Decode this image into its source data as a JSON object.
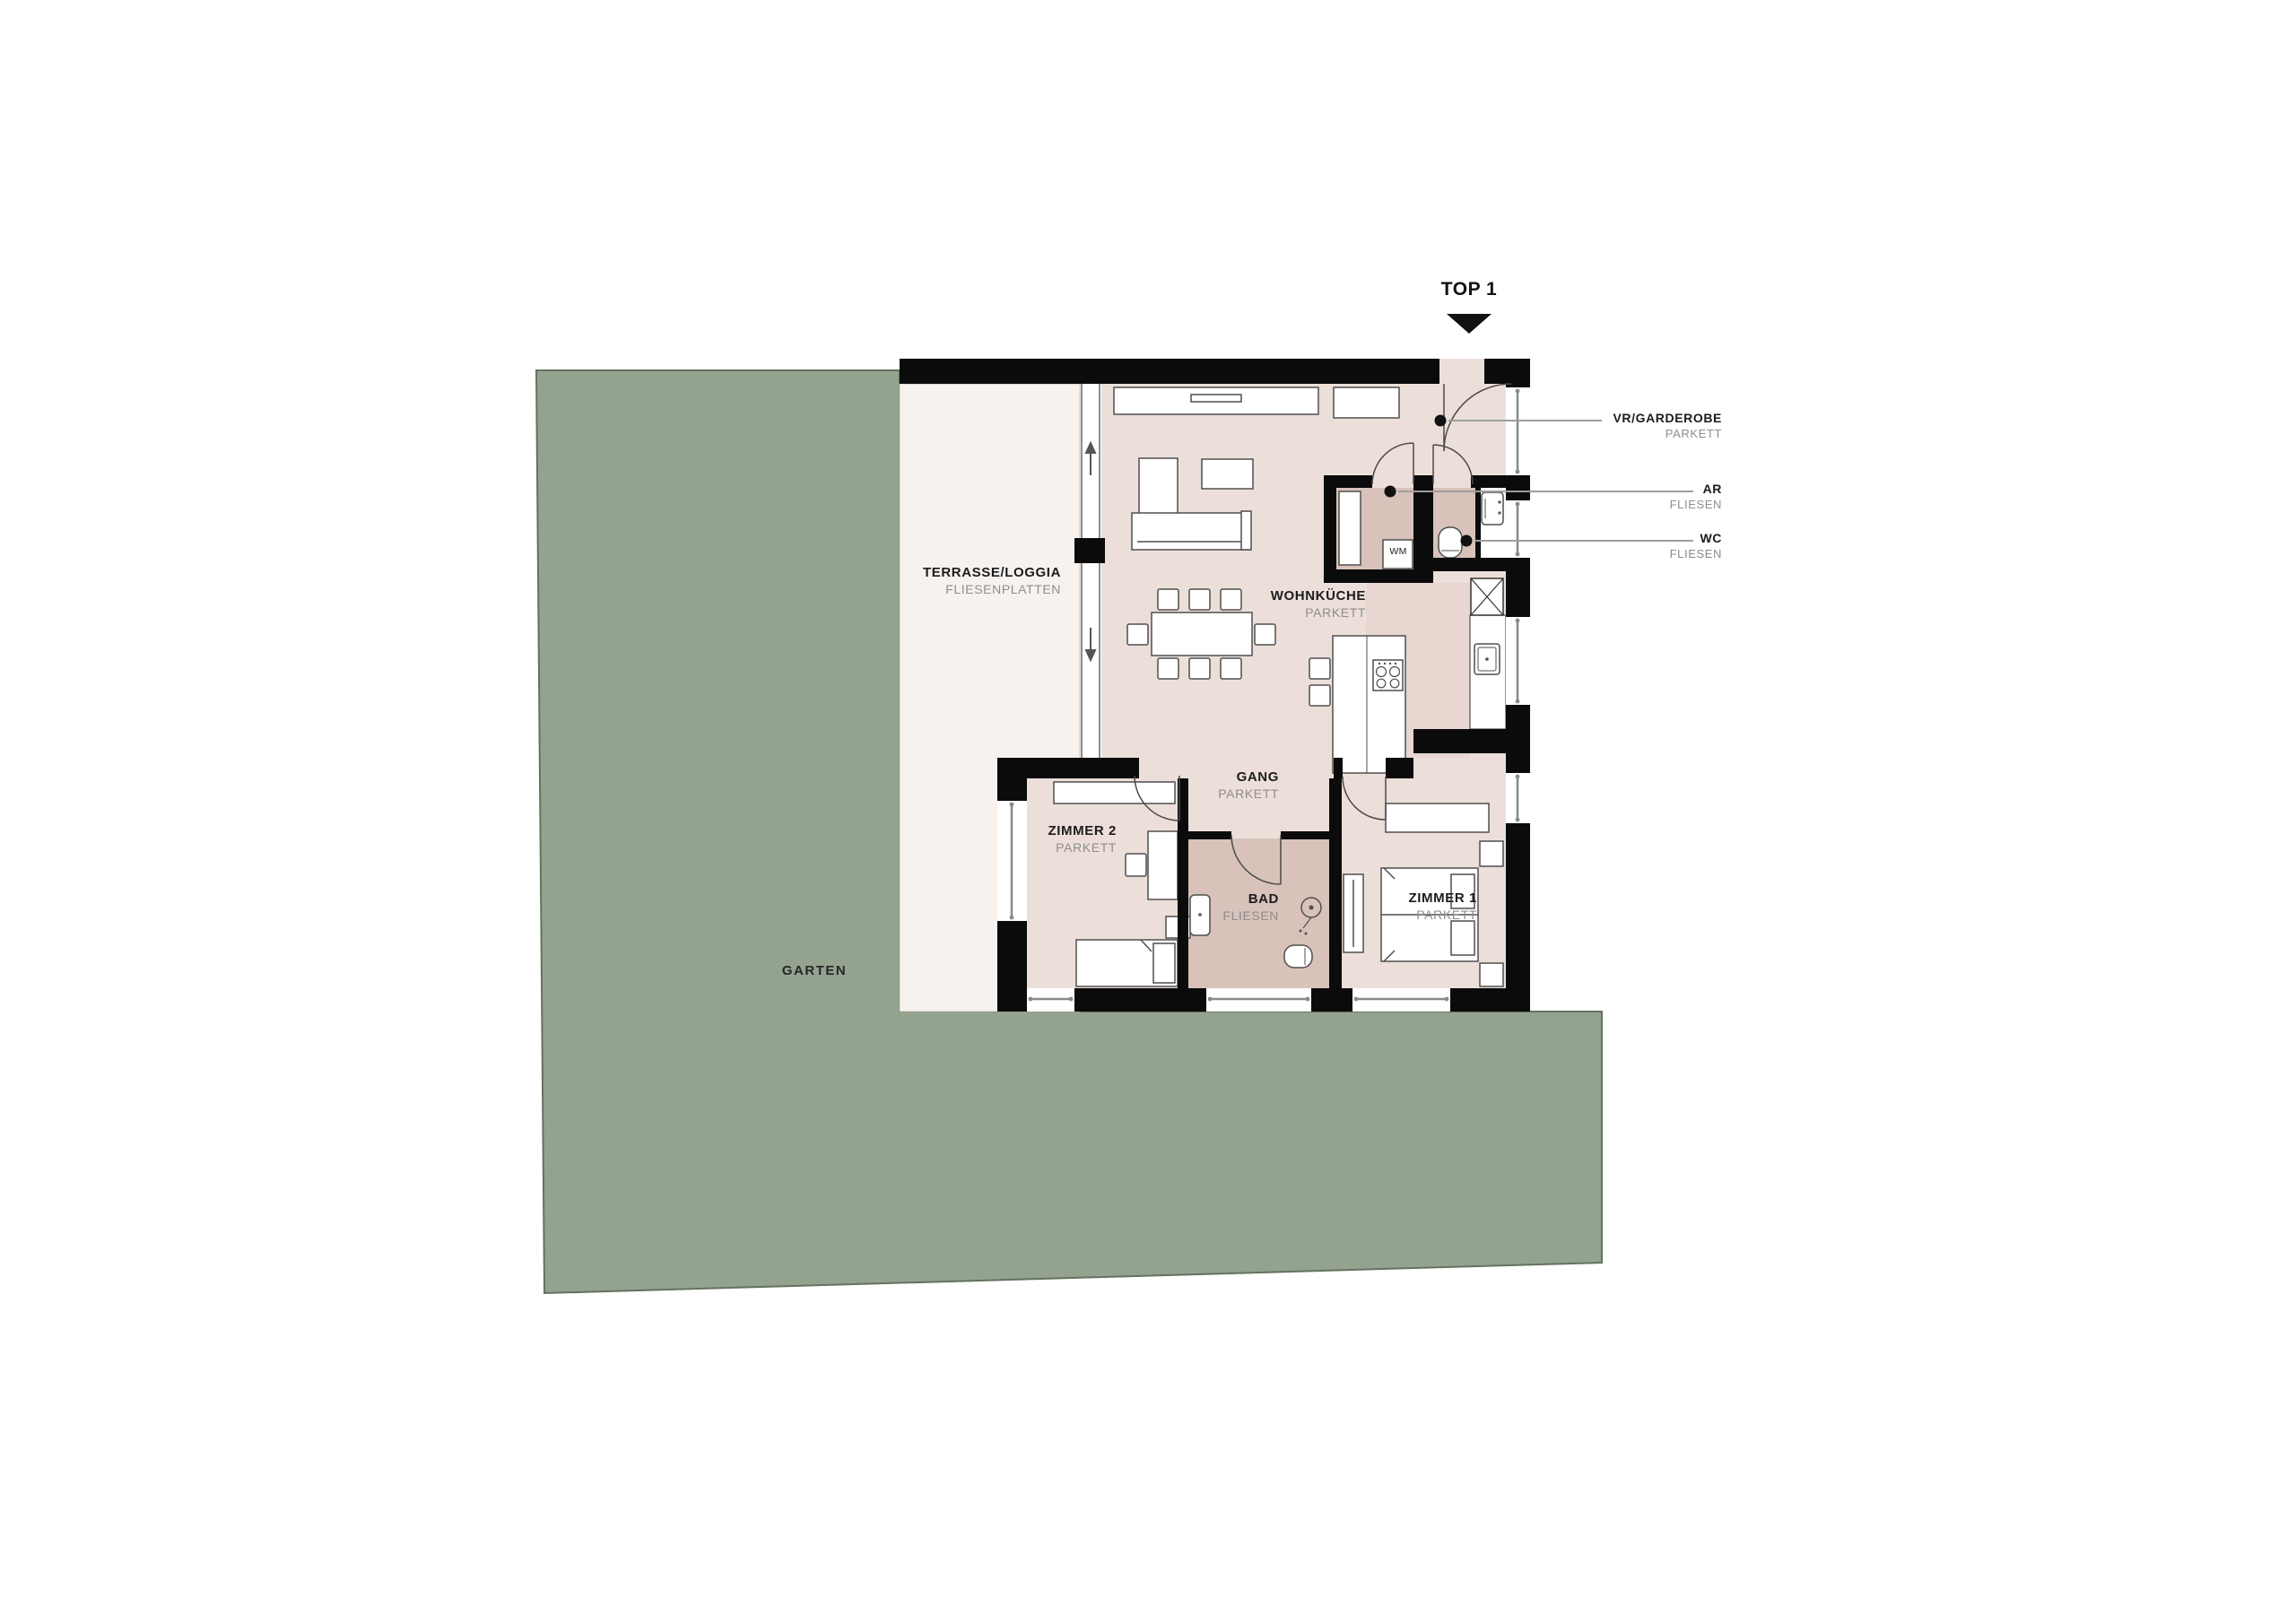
{
  "plan": {
    "title": "TOP 1",
    "garden": {
      "label": "GARTEN"
    },
    "rooms": {
      "terrasse": {
        "name": "TERRASSE/LOGGIA",
        "material": "FLIESENPLATTEN"
      },
      "wohnkueche": {
        "name": "WOHNKÜCHE",
        "material": "PARKETT"
      },
      "gang": {
        "name": "GANG",
        "material": "PARKETT"
      },
      "zimmer2": {
        "name": "ZIMMER 2",
        "material": "PARKETT"
      },
      "bad": {
        "name": "BAD",
        "material": "FLIESEN"
      },
      "zimmer1": {
        "name": "ZIMMER 1",
        "material": "PARKETT"
      }
    },
    "callouts": {
      "vr": {
        "name": "VR/GARDEROBE",
        "material": "PARKETT"
      },
      "ar": {
        "name": "AR",
        "material": "FLIESEN"
      },
      "wc": {
        "name": "WC",
        "material": "FLIESEN"
      }
    },
    "appliances": {
      "washing_machine": "WM"
    },
    "colors": {
      "garden": "#94a38f",
      "garden_outline": "#64725f",
      "terrace_floor": "#f8f2ef",
      "parkett_floor": "#ecdfd9",
      "kitchen_zone": "#e7d7d0",
      "tile_floor": "#d8c2b9",
      "wall": "#0b0b0b",
      "leader_line": "#9e9e9e"
    }
  }
}
